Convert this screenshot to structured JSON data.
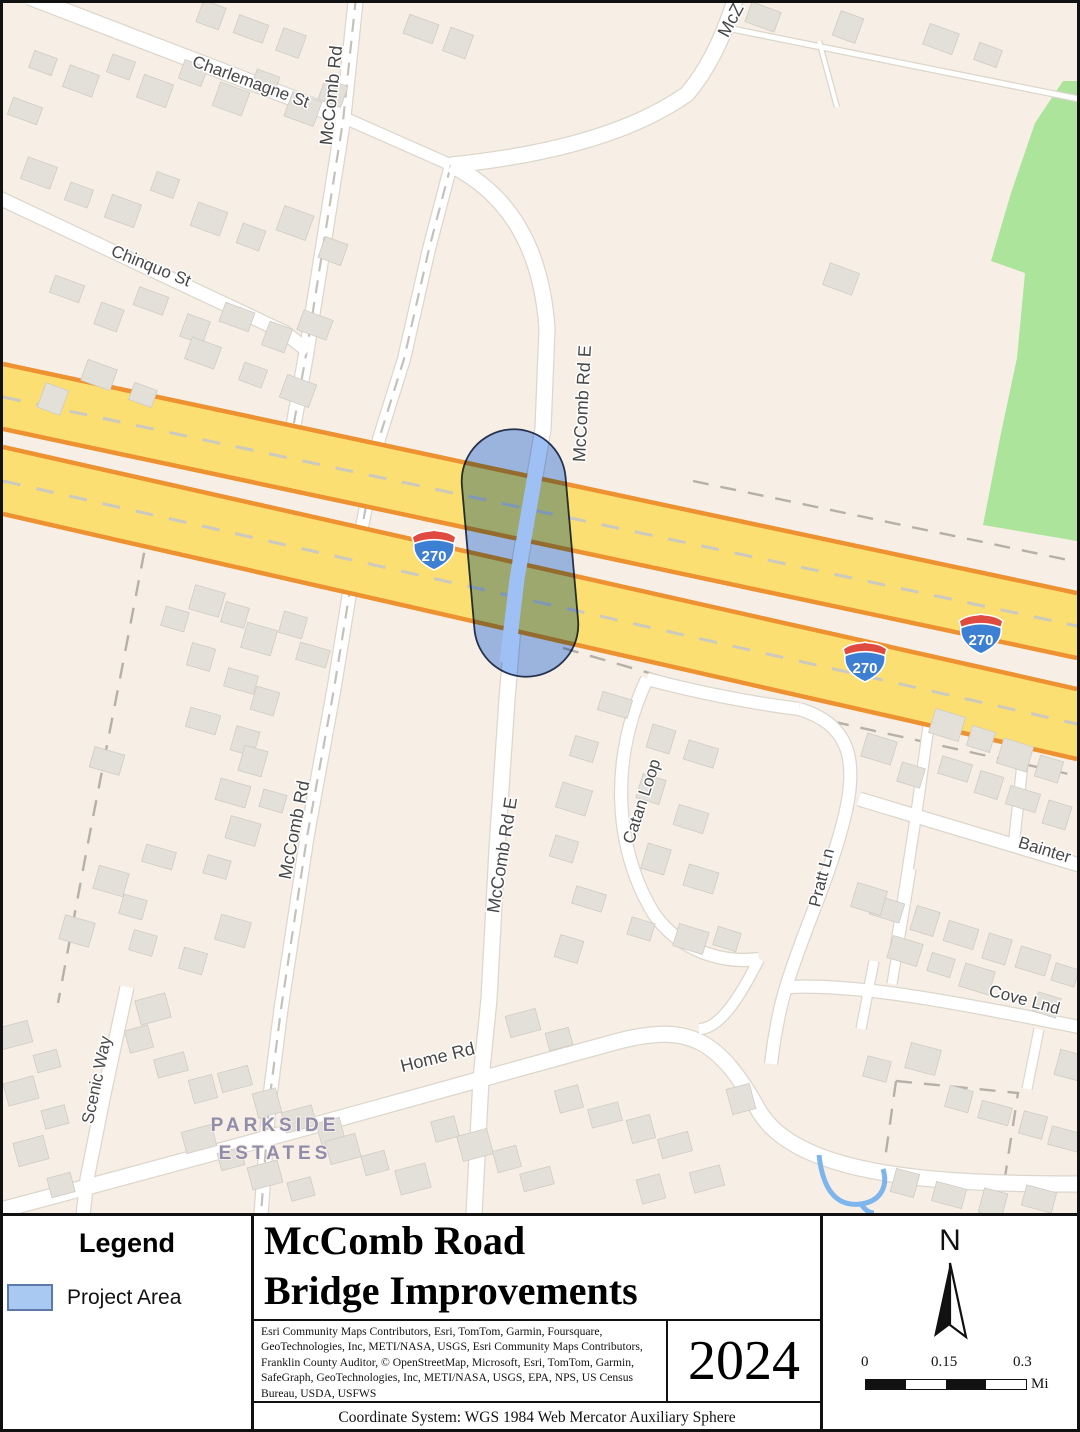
{
  "map": {
    "street_labels": {
      "charlemagne": "Charlemagne St",
      "mccomb_rd_top": "McComb Rd",
      "mcz": "McZ",
      "chinquo": "Chinquo St",
      "mccomb_rd_e_upper": "McComb Rd E",
      "mccomb_rd_lower": "McComb Rd",
      "mccomb_rd_e_lower": "McComb Rd E",
      "catan_loop": "Catan Loop",
      "pratt_ln": "Pratt Ln",
      "bainter": "Bainter",
      "cove_lnd": "Cove Lnd",
      "home_rd": "Home Rd",
      "scenic_way": "Scenic Way"
    },
    "area_labels": {
      "parkside_line1": "PARKSIDE",
      "parkside_line2": "ESTATES"
    },
    "interstate_shield": "270",
    "colors": {
      "background": "#f7efe6",
      "highway_fill": "#fbdf72",
      "highway_edge": "#ee9130",
      "greenspace": "#abe49a",
      "water": "#7db5ec",
      "project_area_fill": "#a9c8f2"
    }
  },
  "legend": {
    "title": "Legend",
    "items": [
      {
        "label": "Project Area",
        "swatch_color": "#a9c8f2"
      }
    ]
  },
  "title_block": {
    "title_line1": "McComb Road",
    "title_line2": "Bridge Improvements",
    "year": "2024",
    "attribution": "Esri Community Maps Contributors, Esri, TomTom, Garmin, Foursquare, GeoTechnologies, Inc, METI/NASA, USGS, Esri Community Maps Contributors, Franklin County Auditor, © OpenStreetMap, Microsoft, Esri, TomTom, Garmin, SafeGraph, GeoTechnologies, Inc, METI/NASA, USGS, EPA, NPS, US Census Bureau, USDA, USFWS",
    "coordinate_system": "Coordinate System: WGS 1984 Web Mercator Auxiliary Sphere"
  },
  "north_arrow_label": "N",
  "scale_bar": {
    "tick_start": "0",
    "tick_mid": "0.15",
    "tick_end": "0.3",
    "unit": "Mi"
  }
}
